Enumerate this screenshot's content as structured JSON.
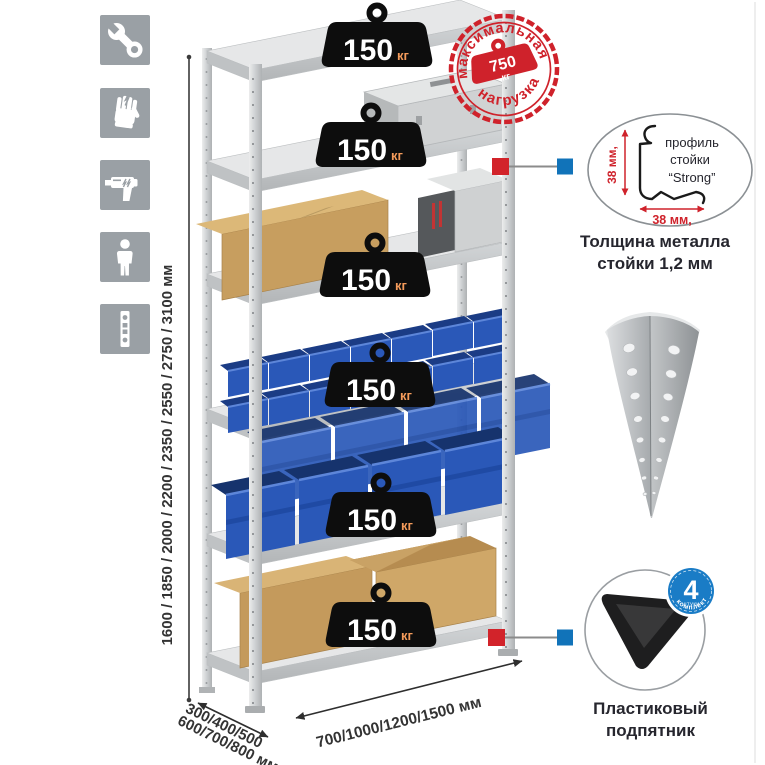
{
  "page": {
    "background": "#ffffff"
  },
  "sidebar": {
    "icons": [
      {
        "name": "wrench-icon"
      },
      {
        "name": "gloves-icon"
      },
      {
        "name": "drill-icon"
      },
      {
        "name": "person-icon"
      },
      {
        "name": "rack-post-icon"
      }
    ]
  },
  "rack": {
    "shelf_count": 6,
    "load_value": "150",
    "load_unit": "кг"
  },
  "stamp": {
    "arc_top": "максимальная",
    "arc_bottom": "нагрузка",
    "value": "750",
    "unit": "кг"
  },
  "dimensions": {
    "height": "1600 / 1850 / 2000 / 2200 / 2350 / 2550 / 2750 / 3100 мм",
    "depth_line1": "300/400/500",
    "depth_line2": "600/700/800 мм",
    "width": "700/1000/1200/1500 мм"
  },
  "profile_detail": {
    "label_line1": "профиль",
    "label_line2": "стойки",
    "label_line3": "“Strong”",
    "dim_side": "38 мм,",
    "dim_bottom": "38 мм,",
    "caption_line1": "Толщина металла",
    "caption_line2": "стойки 1,2 мм"
  },
  "foot_detail": {
    "badge_value": "4",
    "badge_sub": "штуки",
    "badge_arc": "в комплекте",
    "caption_line1": "Пластиковый",
    "caption_line2": "подпятник"
  },
  "colors": {
    "accent_red": "#d0242c",
    "accent_blue": "#1173b9",
    "badge_blue": "#1a7cc6",
    "bin_blue": "#2a58b8",
    "tile_gray": "#9aa0a5",
    "weight_black": "#0d0d0d"
  }
}
